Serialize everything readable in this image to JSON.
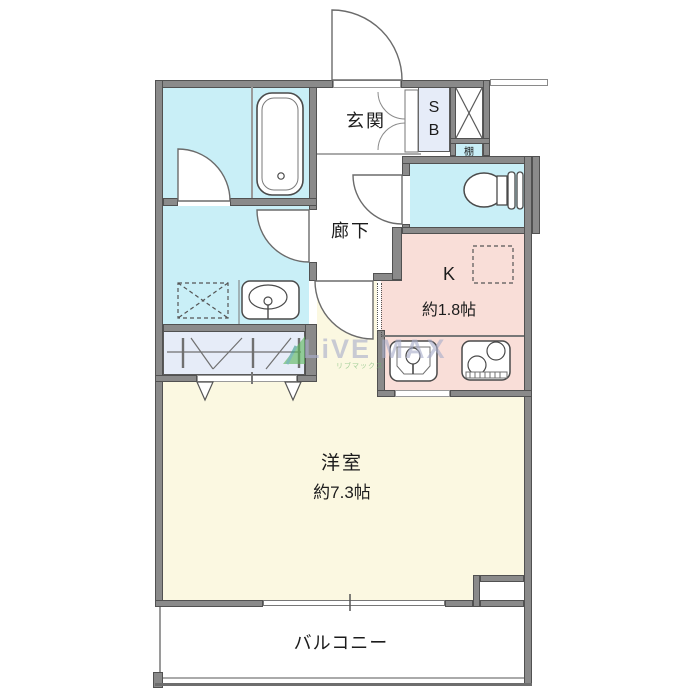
{
  "rooms": {
    "genkan": {
      "label": "玄関"
    },
    "hallway": {
      "label": "廊下"
    },
    "kitchen": {
      "label": "K",
      "size": "約1.8帖"
    },
    "western_room": {
      "label": "洋室",
      "size": "約7.3帖"
    },
    "balcony": {
      "label": "バルコニー"
    },
    "shoe_box": {
      "line1": "S",
      "line2": "B"
    },
    "shelf": {
      "label": "棚"
    }
  },
  "fixtures": [
    "bathtub",
    "toilet",
    "vanity-sink",
    "washing-machine-space",
    "refrigerator-space",
    "kitchen-sink",
    "gas-stove",
    "closet-hanger-rail",
    "pipe-shaft"
  ],
  "watermark": {
    "brand": "LiVE MAX",
    "furigana": "リブマックス"
  },
  "colors": {
    "wet_area": "#c9eff7",
    "kitchen": "#f9ded8",
    "room": "#fbf8e1",
    "cabinet": "#e6ecf8",
    "wall": "#8a8a8a",
    "watermark_text": "#bcc0d6",
    "watermark_green": "#5cb85c"
  }
}
